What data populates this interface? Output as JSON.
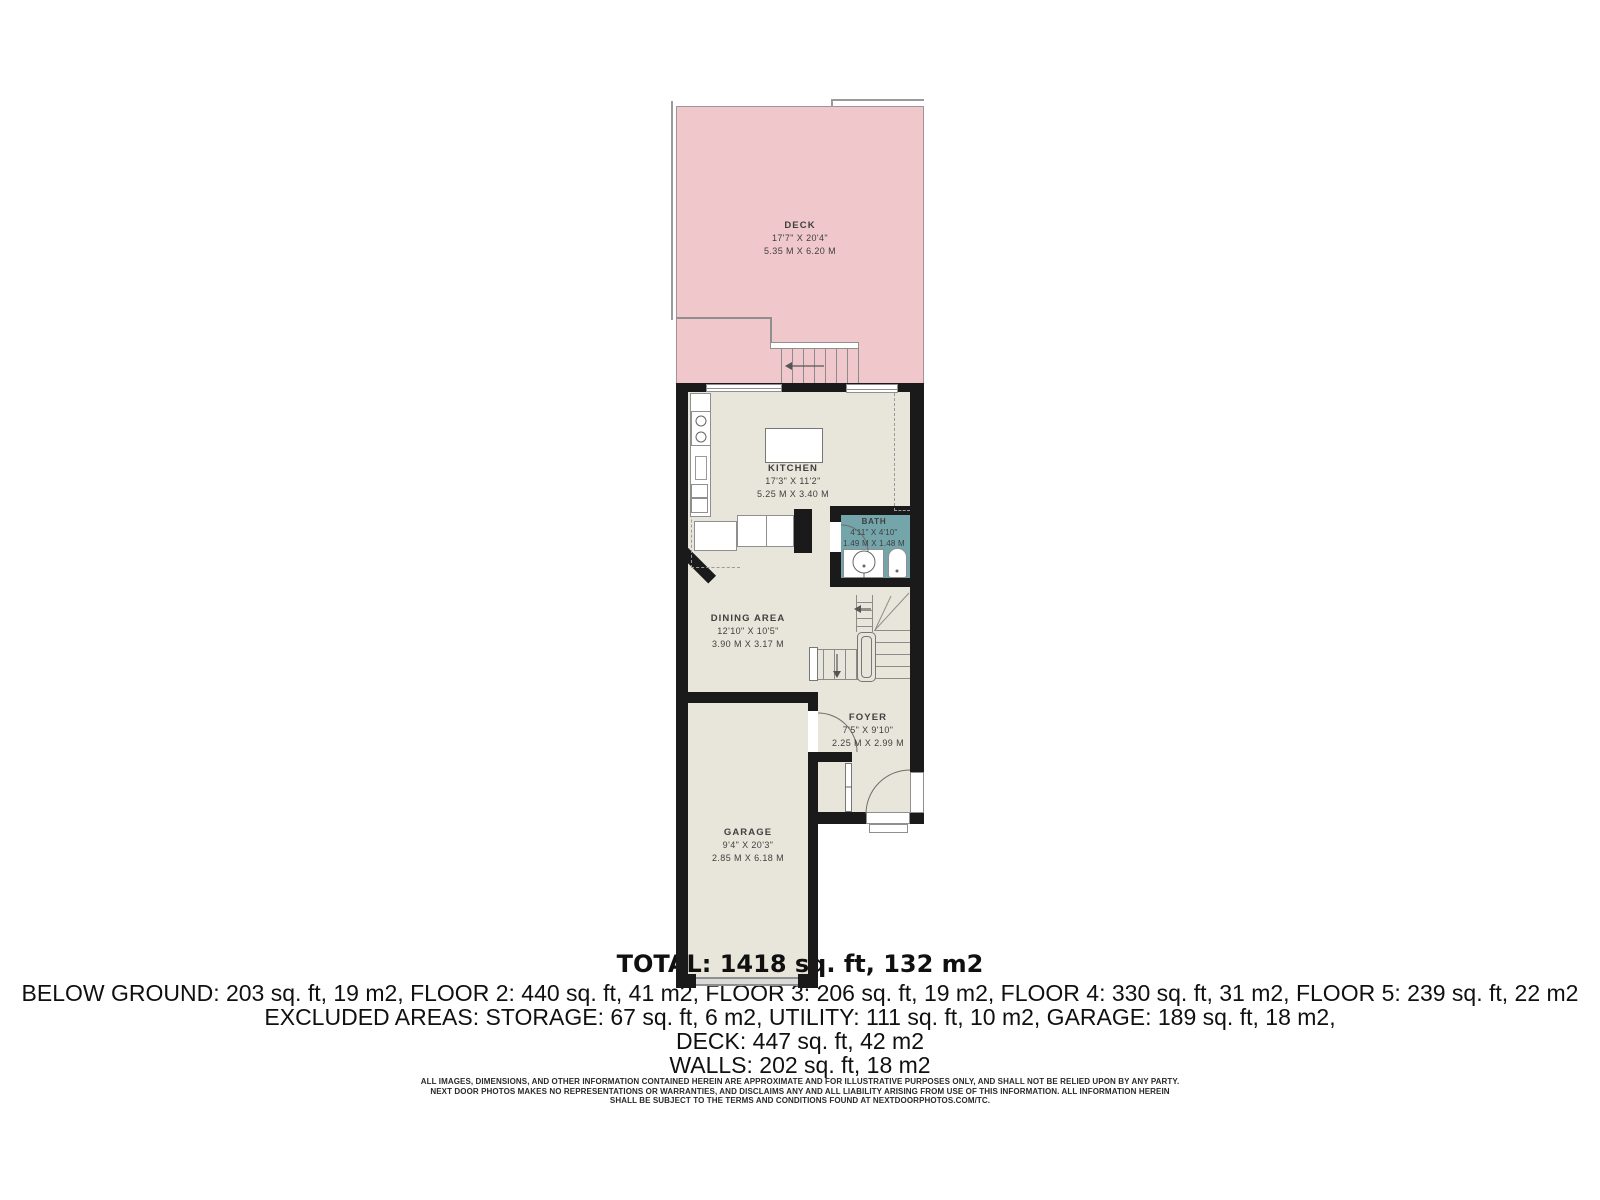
{
  "plan": {
    "rooms": [
      {
        "name": "DECK",
        "imperial": "17'7\" X 20'4\"",
        "metric": "5.35 M X 6.20 M"
      },
      {
        "name": "KITCHEN",
        "imperial": "17'3\" X 11'2\"",
        "metric": "5.25 M X 3.40 M"
      },
      {
        "name": "BATH",
        "imperial": "4'11\" X 4'10\"",
        "metric": "1.49 M X 1.48 M"
      },
      {
        "name": "DINING AREA",
        "imperial": "12'10\" X 10'5\"",
        "metric": "3.90 M X 3.17 M"
      },
      {
        "name": "FOYER",
        "imperial": "7'5\" X 9'10\"",
        "metric": "2.25 M X 2.99 M"
      },
      {
        "name": "GARAGE",
        "imperial": "9'4\" X 20'3\"",
        "metric": "2.85 M X 6.18 M"
      }
    ],
    "colors": {
      "deck_fill": "#f0c8cb",
      "floor_fill": "#e8e6db",
      "bath_fill": "#73a5ab",
      "wall": "#1a1a1a",
      "thin_line": "#8f8f8f"
    }
  },
  "summary": {
    "total": "TOTAL: 1418 sq. ft, 132 m2",
    "floors_line": "BELOW GROUND: 203 sq. ft, 19 m2, FLOOR 2: 440 sq. ft, 41 m2, FLOOR 3: 206 sq. ft, 19 m2, FLOOR 4: 330 sq. ft, 31 m2, FLOOR 5: 239 sq. ft, 22 m2",
    "excluded_line": "EXCLUDED AREAS: STORAGE: 67 sq. ft, 6 m2, UTILITY: 111 sq. ft, 10 m2, GARAGE: 189 sq. ft, 18 m2,",
    "deck_line": "DECK: 447 sq. ft, 42 m2",
    "walls_line": "WALLS: 202 sq. ft, 18 m2"
  },
  "disclaimer": {
    "line1": "ALL IMAGES, DIMENSIONS, AND OTHER INFORMATION CONTAINED HEREIN ARE APPROXIMATE AND FOR ILLUSTRATIVE PURPOSES ONLY, AND SHALL NOT BE RELIED UPON BY ANY PARTY.",
    "line2": "NEXT DOOR PHOTOS MAKES NO REPRESENTATIONS OR WARRANTIES, AND DISCLAIMS ANY AND ALL LIABILITY ARISING FROM USE OF THIS INFORMATION. ALL INFORMATION HEREIN",
    "line3": "SHALL BE SUBJECT TO THE TERMS AND CONDITIONS FOUND AT NEXTDOORPHOTOS.COM/TC."
  }
}
